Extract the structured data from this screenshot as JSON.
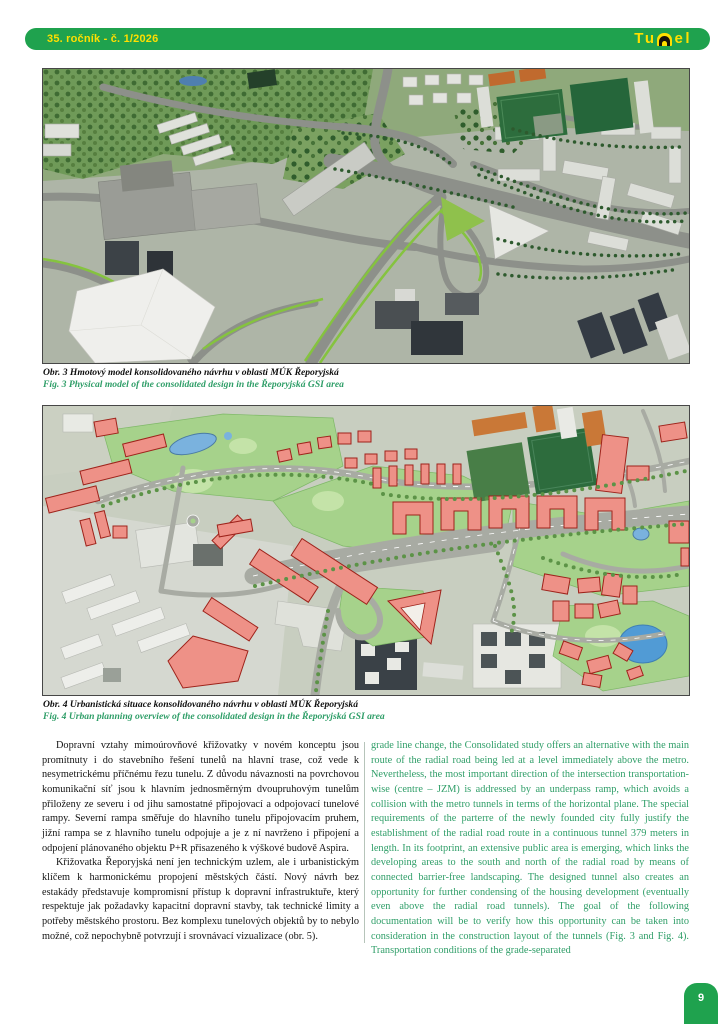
{
  "header": {
    "issue": "35. ročník - č. 1/2026",
    "logo_left": "Tu",
    "logo_tunnel_letter": "n",
    "logo_right": "el"
  },
  "figures": {
    "fig3": {
      "caption_cs": "Obr. 3 Hmotový model konsolidovaného návrhu v oblasti MÚK Řeporyjská",
      "caption_en": "Fig. 3 Physical model of the consolidated design in the Řeporyjská GSI area"
    },
    "fig4": {
      "caption_cs": "Obr. 4 Urbanistická situace konsolidovaného návrhu v oblasti MÚK Řeporyjská",
      "caption_en": "Fig. 4 Urban planning overview of the consolidated design in the Řeporyjská GSI area"
    }
  },
  "article": {
    "czech": [
      "Dopravní vztahy mimoúrovňové křižovatky v novém konceptu jsou promítnuty i do stavebního řešení tunelů na hlavní trase, což vede k nesymetrickému příčnému řezu tunelu. Z důvodu návaznosti na povrchovou komunikační síť jsou k hlavním jednosměrným dvoupruhovým tunelům přiloženy ze severu i od jihu samostatné připojovací a odpojovací tunelové rampy. Severní rampa směřuje do hlavního tunelu připojovacím pruhem, jižní rampa se z hlavního tunelu odpojuje a je z ní navrženo i připojení a odpojení plánovaného objektu P+R přisazeného k výškové budově Aspira.",
      "Křižovatka Řeporyjská není jen technickým uzlem, ale i urbanistickým klíčem k harmonickému propojení městských částí. Nový návrh bez estakády představuje kompromisní přístup k dopravní infrastruktuře, který respektuje jak požadavky kapacitní dopravní stavby, tak technické limity a potřeby městského prostoru. Bez komplexu tunelových objektů by to nebylo možné, což nepochybně potvrzují i srovnávací vizualizace (obr. 5)."
    ],
    "english": "grade line change, the Consolidated study offers an alternative with the main route of the radial road being led at a level immediately above the metro. Nevertheless, the most important direction of the intersection transportation-wise (centre – JZM) is addressed by an underpass ramp, which avoids a collision with the metro tunnels in terms of the horizontal plane. The special requirements of the parterre of the newly founded city fully justify the establishment of the radial road route in a continuous tunnel 379 meters in length. In its footprint, an extensive public area is emerging, which links the developing areas to the south and north of the radial road by means of connected barrier-free landscaping. The designed tunnel also creates an opportunity for further condensing of the housing development (eventually even above the radial road tunnels). The goal of the following documentation will be to verify how this opportunity can be taken into consideration in the construction layout of the tunnels (Fig. 3 and Fig. 4). Transportation conditions of the grade-separated"
  },
  "page_number": "9",
  "colors": {
    "header_green": "#1fa24e",
    "accent_yellow": "#ffdf00",
    "english_text_green": "#2f9e68",
    "figure_red_overlay": "#ee9187",
    "figure_red_outline": "#9e231b",
    "park_green": "#a6d28b",
    "pitch_green": "#2d6d3d"
  }
}
